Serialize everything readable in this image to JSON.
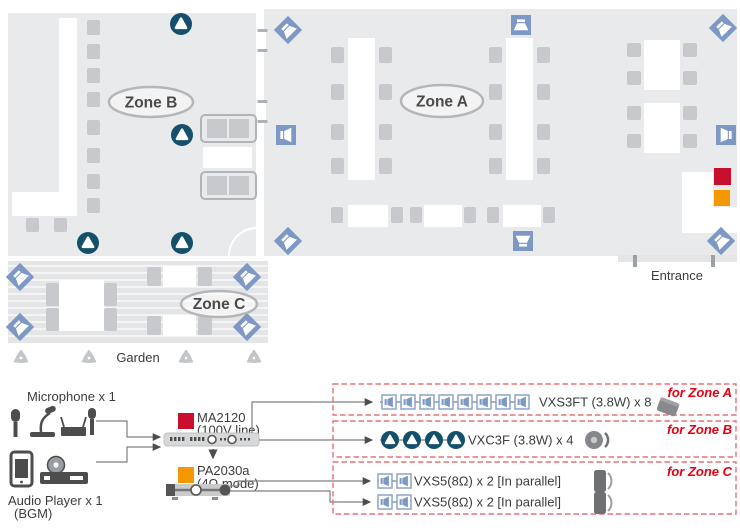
{
  "floorplan": {
    "zone_a_label": "Zone A",
    "zone_b_label": "Zone B",
    "zone_c_label": "Zone C",
    "garden_label": "Garden",
    "entrance_label": "Entrance",
    "speaker_counts": {
      "zone_a_wall": 8,
      "zone_b_ceiling": 4,
      "zone_c_wall": 4
    }
  },
  "system_diagram": {
    "microphone_label": "Microphone x 1",
    "audio_player_label": "Audio Player x 1",
    "audio_player_sublabel": "(BGM)",
    "amplifiers": [
      {
        "model": "MA2120",
        "mode": "(100V line)",
        "marker_color": "#c8102e"
      },
      {
        "model": "PA2030a",
        "mode": "(4Ω mode)",
        "marker_color": "#f39800"
      }
    ],
    "chains": [
      {
        "target_label": "for Zone A",
        "speaker_label": "VXS3FT (3.8W) x 8",
        "icon_count": 8
      },
      {
        "target_label": "for Zone B",
        "speaker_label": "VXC3F (3.8W) x 4",
        "icon_count": 4
      },
      {
        "target_label": "for Zone C",
        "rows": [
          "VXS5(8Ω) x 2 [In parallel]",
          "VXS5(8Ω) x 2 [In parallel]"
        ]
      }
    ]
  },
  "icons": {
    "wall_speaker_icon": "blue square with white horn",
    "ceiling_speaker_icon": "teal circle with white triangle",
    "tree_icon": "gray shrub (top view)",
    "down_arrow_icon": "↓",
    "flow_arrow_icon": "→"
  },
  "colors": {
    "room_fill": "#e9eaeb",
    "furniture_gray": "#c7c9cc",
    "wall_speaker_blue": "#7d98c4",
    "ceiling_speaker_teal": "#14506b",
    "zone_label_red": "#e60012",
    "dashed_box_red": "#e57373"
  }
}
